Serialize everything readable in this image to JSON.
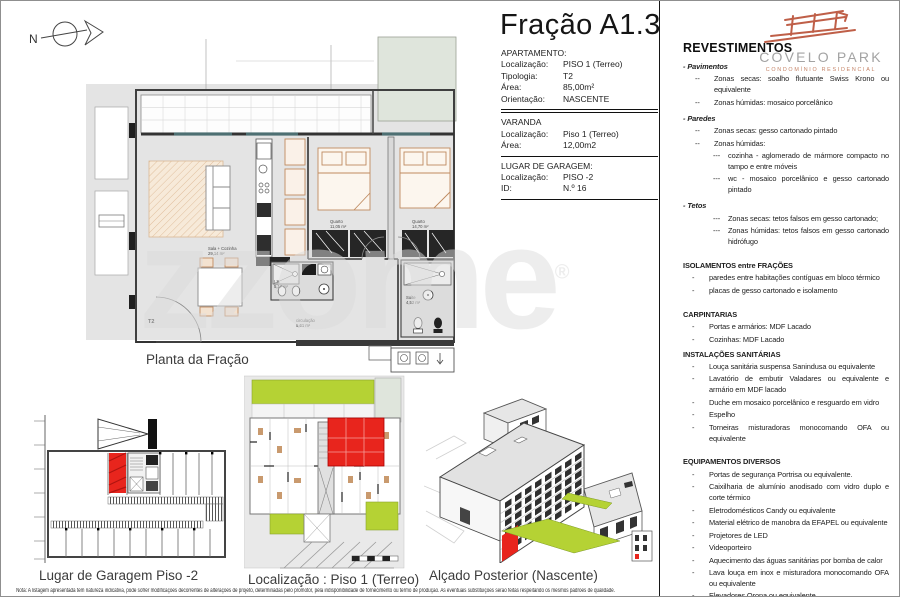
{
  "page": {
    "title": "Fração A1.3",
    "watermark": "zzome",
    "watermark_reg": "®",
    "disclaimer": "Nota: A listagem apresentada tem natureza indicativa, pode sofrer modificações decorrentes de alterações de projeto, determinadas pelo promotor, pela indisponibilidade de fornecimento ou termo de produção. As eventuais substituições serão feitas respeitando os mesmos padrões de qualidade."
  },
  "north": {
    "label": "N"
  },
  "info": {
    "apartamento": {
      "header": "APARTAMENTO:",
      "rows": [
        {
          "label": "Localização:",
          "value": "PISO 1 (Terreo)"
        },
        {
          "label": "Tipologia:",
          "value": "T2"
        },
        {
          "label": "Área:",
          "value": "85,00m²"
        },
        {
          "label": "Orientação:",
          "value": "NASCENTE"
        }
      ]
    },
    "varanda": {
      "header": "VARANDA",
      "rows": [
        {
          "label": "Localização:",
          "value": "Piso 1 (Terreo)"
        },
        {
          "label": "Área:",
          "value": "12,00m2"
        }
      ]
    },
    "garagem": {
      "header": "LUGAR DE GARAGEM:",
      "rows": [
        {
          "label": "Localização:",
          "value": "PISO -2"
        },
        {
          "label": "ID:",
          "value": "N.º 16"
        }
      ]
    }
  },
  "plan": {
    "caption": "Planta da Fração",
    "entry_label": "T2",
    "rooms": [
      {
        "name": "Sala + Cozinha",
        "area": "29,14 m²"
      },
      {
        "name": "Quarto",
        "area": "11,05 m²"
      },
      {
        "name": "Quarto",
        "area": "14,70 m²"
      },
      {
        "name": "I.S.",
        "area": "5,17 m²"
      },
      {
        "name": "circulação",
        "area": "5,61 m²"
      },
      {
        "name": "Suite",
        "area": "4,52 m²"
      }
    ]
  },
  "drawings": {
    "garage": {
      "caption": "Lugar de Garagem Piso -2"
    },
    "location": {
      "caption": "Localização : Piso 1 (Terreo)"
    },
    "elevation": {
      "caption": "Alçado Posterior (Nascente)"
    }
  },
  "brand": {
    "name": "COVELO PARK",
    "tagline": "CONDOMÍNIO RESIDENCIAL"
  },
  "specs": {
    "title": "REVESTIMENTOS",
    "entries": [
      {
        "kind": "h-italic",
        "t": "- Pavimentos"
      },
      {
        "kind": "li2",
        "b": "--",
        "t": "Zonas secas: soalho flutuante Swiss Krono ou equivalente"
      },
      {
        "kind": "li2",
        "b": "--",
        "t": "Zonas húmidas: mosaico porcelânico"
      },
      {
        "kind": "h-italic",
        "t": "- Paredes"
      },
      {
        "kind": "li2",
        "b": "--",
        "t": "Zonas secas: gesso cartonado pintado"
      },
      {
        "kind": "li2",
        "b": "--",
        "t": "Zonas húmidas:"
      },
      {
        "kind": "li3",
        "b": "---",
        "t": "cozinha - aglomerado de mármore compacto no tampo e entre móveis"
      },
      {
        "kind": "li3",
        "b": "---",
        "t": "wc - mosaico porcelânico e gesso cartonado pintado"
      },
      {
        "kind": "h-italic",
        "t": "- Tetos"
      },
      {
        "kind": "li3",
        "b": "---",
        "t": "Zonas secas: tetos falsos em gesso cartonado;"
      },
      {
        "kind": "li3",
        "b": "---",
        "t": "Zonas húmidas: tetos falsos em gesso cartonado hidrófugo"
      },
      {
        "kind": "h-caps",
        "t": "ISOLAMENTOS entre FRAÇÕES"
      },
      {
        "kind": "li1",
        "b": "-",
        "t": "paredes entre habitações contíguas em bloco térmico"
      },
      {
        "kind": "li1",
        "b": "-",
        "t": "placas de gesso cartonado e isolamento"
      },
      {
        "kind": "h-caps",
        "t": "CARPINTARIAS"
      },
      {
        "kind": "li1",
        "b": "-",
        "t": "Portas e armários: MDF Lacado"
      },
      {
        "kind": "li1",
        "b": "-",
        "t": "Cozinhas: MDF Lacado"
      },
      {
        "kind": "h-caps-small",
        "t": "INSTALAÇÕES SANITÁRIAS"
      },
      {
        "kind": "li1",
        "b": "-",
        "t": "Louça sanitária suspensa Sanindusa ou equivalente"
      },
      {
        "kind": "li1",
        "b": "-",
        "t": "Lavatório de embutir Valadares ou equivalente e armário em MDF lacado"
      },
      {
        "kind": "li1",
        "b": "-",
        "t": "Duche em mosaico porcelânico e resguardo em vidro"
      },
      {
        "kind": "li1",
        "b": "-",
        "t": "Espelho"
      },
      {
        "kind": "li1",
        "b": "-",
        "t": "Torneiras misturadoras monocomando OFA ou equivalente"
      },
      {
        "kind": "h-caps",
        "t": "EQUIPAMENTOS DIVERSOS"
      },
      {
        "kind": "li1",
        "b": "-",
        "t": "Portas de segurança Portrisa ou equivalente."
      },
      {
        "kind": "li1",
        "b": "-",
        "t": "Caixilharia de alumínio anodisado com vidro duplo e corte térmico"
      },
      {
        "kind": "li1",
        "b": "-",
        "t": "Eletrodomésticos Candy ou equivalente"
      },
      {
        "kind": "li1",
        "b": "-",
        "t": "Material elétrico de manobra da EFAPEL ou equivalente"
      },
      {
        "kind": "li1",
        "b": "-",
        "t": "Projetores de LED"
      },
      {
        "kind": "li1",
        "b": "-",
        "t": "Videoporteiro"
      },
      {
        "kind": "li1",
        "b": "-",
        "t": "Aquecimento das águas sanitárias por bomba de calor"
      },
      {
        "kind": "li1",
        "b": "-",
        "t": "Lava louça em inox e misturadora monocomando OFA ou equivalente"
      },
      {
        "kind": "li1",
        "b": "-",
        "t": "Elevadores Orona ou equivalente"
      },
      {
        "kind": "li1",
        "b": "-",
        "t": "Pré-instalação de ar condicionado"
      }
    ]
  },
  "colors": {
    "red": "#e8251d",
    "green": "#b5d234",
    "pale_green": "#dfe5dc",
    "tan": "#bf8a5f",
    "logo": "#bf5f48",
    "wall": "#3f3f3f"
  }
}
